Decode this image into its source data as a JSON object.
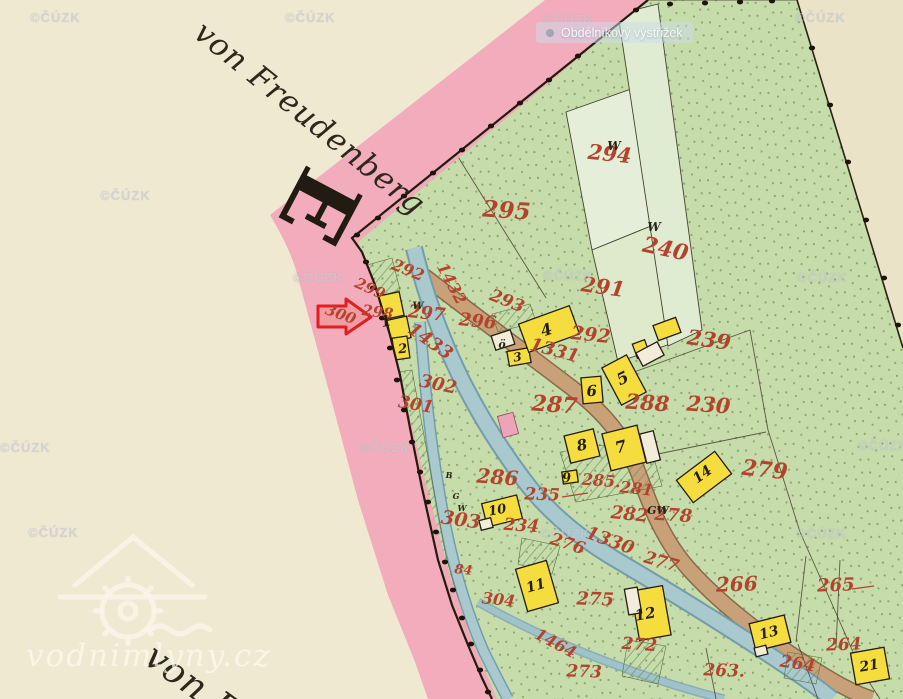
{
  "overlay": {
    "copyright": "©ČÚZK",
    "clip_label": "Obdélníkový výstřižek",
    "brand": "vodnimlyny.cz",
    "watermarks": [
      {
        "x": 30,
        "y": 10
      },
      {
        "x": 285,
        "y": 10
      },
      {
        "x": 543,
        "y": 12
      },
      {
        "x": 795,
        "y": 10
      },
      {
        "x": 100,
        "y": 188
      },
      {
        "x": 293,
        "y": 270
      },
      {
        "x": 543,
        "y": 268
      },
      {
        "x": 797,
        "y": 270
      },
      {
        "x": 0,
        "y": 440
      },
      {
        "x": 360,
        "y": 440
      },
      {
        "x": 858,
        "y": 438
      },
      {
        "x": 28,
        "y": 525
      },
      {
        "x": 540,
        "y": 526
      },
      {
        "x": 796,
        "y": 526
      }
    ]
  },
  "map": {
    "titles": [
      {
        "t": "von Freudenberg",
        "x": 192,
        "y": 36,
        "r": 39,
        "s": 31,
        "kind": "script",
        "n": "region-name-top"
      },
      {
        "t": "E",
        "x": 308,
        "y": 162,
        "r": 118,
        "s": 88,
        "kind": "capital",
        "n": "initial-letter"
      },
      {
        "t": "von F",
        "x": 142,
        "y": 662,
        "r": 36,
        "s": 36,
        "kind": "script",
        "n": "region-name-bottom"
      }
    ],
    "parcel_labels": [
      {
        "t": "295",
        "x": 506,
        "y": 218,
        "r": 4,
        "s": 23
      },
      {
        "t": "294",
        "x": 609,
        "y": 161,
        "r": 6,
        "s": 21
      },
      {
        "t": "291",
        "x": 602,
        "y": 294,
        "r": 8,
        "s": 21
      },
      {
        "t": "240",
        "x": 664,
        "y": 256,
        "r": 12,
        "s": 22
      },
      {
        "t": "239",
        "x": 708,
        "y": 347,
        "r": 8,
        "s": 21
      },
      {
        "t": "292",
        "x": 406,
        "y": 275,
        "r": 22,
        "s": 16
      },
      {
        "t": "299",
        "x": 368,
        "y": 293,
        "r": 24,
        "s": 15
      },
      {
        "t": "300",
        "x": 339,
        "y": 319,
        "r": 20,
        "s": 15
      },
      {
        "t": "298",
        "x": 377,
        "y": 317,
        "r": 8,
        "s": 15
      },
      {
        "t": "297",
        "x": 426,
        "y": 319,
        "r": 6,
        "s": 18
      },
      {
        "t": "296",
        "x": 477,
        "y": 327,
        "r": 6,
        "s": 18
      },
      {
        "t": "293",
        "x": 505,
        "y": 306,
        "r": 22,
        "s": 17
      },
      {
        "t": "292",
        "x": 590,
        "y": 341,
        "r": 6,
        "s": 19
      },
      {
        "t": "1433",
        "x": 427,
        "y": 346,
        "r": 35,
        "s": 18
      },
      {
        "t": "1432",
        "x": 447,
        "y": 286,
        "r": 62,
        "s": 16
      },
      {
        "t": "1331",
        "x": 553,
        "y": 356,
        "r": 15,
        "s": 18
      },
      {
        "t": "302",
        "x": 437,
        "y": 390,
        "r": 12,
        "s": 18
      },
      {
        "t": "301",
        "x": 415,
        "y": 410,
        "r": 10,
        "s": 17
      },
      {
        "t": "287",
        "x": 554,
        "y": 412,
        "r": 4,
        "s": 22
      },
      {
        "t": "288",
        "x": 647,
        "y": 410,
        "r": 4,
        "s": 21
      },
      {
        "t": "230",
        "x": 708,
        "y": 412,
        "r": 4,
        "s": 21
      },
      {
        "t": "303",
        "x": 460,
        "y": 526,
        "r": 8,
        "s": 19
      },
      {
        "t": "84",
        "x": 463,
        "y": 574,
        "r": 6,
        "s": 13
      },
      {
        "t": "304",
        "x": 498,
        "y": 605,
        "r": 6,
        "s": 16
      },
      {
        "t": "286",
        "x": 497,
        "y": 484,
        "r": 4,
        "s": 20
      },
      {
        "t": "235",
        "x": 542,
        "y": 500,
        "r": 2,
        "s": 17
      },
      {
        "t": "234",
        "x": 521,
        "y": 531,
        "r": 4,
        "s": 17
      },
      {
        "t": "285.",
        "x": 601,
        "y": 486,
        "r": 4,
        "s": 16
      },
      {
        "t": "281",
        "x": 636,
        "y": 494,
        "r": 6,
        "s": 16
      },
      {
        "t": "282",
        "x": 629,
        "y": 520,
        "r": 6,
        "s": 18
      },
      {
        "t": "278",
        "x": 673,
        "y": 521,
        "r": 4,
        "s": 18
      },
      {
        "t": "279",
        "x": 764,
        "y": 477,
        "r": 6,
        "s": 22
      },
      {
        "t": "276",
        "x": 566,
        "y": 549,
        "r": 18,
        "s": 17
      },
      {
        "t": "1330",
        "x": 608,
        "y": 546,
        "r": 20,
        "s": 18
      },
      {
        "t": "277",
        "x": 660,
        "y": 567,
        "r": 16,
        "s": 17
      },
      {
        "t": "275",
        "x": 595,
        "y": 605,
        "r": 2,
        "s": 18
      },
      {
        "t": "266",
        "x": 737,
        "y": 591,
        "r": -2,
        "s": 20
      },
      {
        "t": "265",
        "x": 836,
        "y": 591,
        "r": -2,
        "s": 18
      },
      {
        "t": "264",
        "x": 844,
        "y": 650,
        "r": -2,
        "s": 17
      },
      {
        "t": "264",
        "x": 797,
        "y": 669,
        "r": 8,
        "s": 17
      },
      {
        "t": "263.",
        "x": 724,
        "y": 676,
        "r": 2,
        "s": 17
      },
      {
        "t": "272",
        "x": 639,
        "y": 650,
        "r": 4,
        "s": 17
      },
      {
        "t": "273",
        "x": 584,
        "y": 677,
        "r": 2,
        "s": 17
      },
      {
        "t": "1464",
        "x": 553,
        "y": 648,
        "r": 28,
        "s": 16
      }
    ],
    "building_numbers": [
      {
        "t": "1",
        "x": 387,
        "y": 326,
        "r": -12,
        "s": 15
      },
      {
        "t": "2",
        "x": 403,
        "y": 353,
        "r": -5,
        "s": 13
      },
      {
        "t": "3",
        "x": 518,
        "y": 361,
        "r": -8,
        "s": 12
      },
      {
        "t": "4",
        "x": 548,
        "y": 335,
        "r": -18,
        "s": 16
      },
      {
        "t": "5",
        "x": 625,
        "y": 383,
        "r": -26,
        "s": 16
      },
      {
        "t": "6",
        "x": 592,
        "y": 396,
        "r": -3,
        "s": 15
      },
      {
        "t": "7",
        "x": 622,
        "y": 452,
        "r": -14,
        "s": 16
      },
      {
        "t": "8",
        "x": 583,
        "y": 450,
        "r": -12,
        "s": 15
      },
      {
        "t": "9",
        "x": 567,
        "y": 482,
        "r": -5,
        "s": 13
      },
      {
        "t": "10",
        "x": 498,
        "y": 514,
        "r": -10,
        "s": 13
      },
      {
        "t": "11",
        "x": 537,
        "y": 590,
        "r": -16,
        "s": 14
      },
      {
        "t": "12",
        "x": 646,
        "y": 619,
        "r": -10,
        "s": 15
      },
      {
        "t": "13",
        "x": 770,
        "y": 637,
        "r": -14,
        "s": 14
      },
      {
        "t": "14",
        "x": 705,
        "y": 478,
        "r": -36,
        "s": 14
      },
      {
        "t": "21",
        "x": 870,
        "y": 670,
        "r": -10,
        "s": 14
      }
    ],
    "symbols": [
      {
        "t": "W",
        "x": 614,
        "y": 150,
        "r": 0,
        "s": 12
      },
      {
        "t": "W",
        "x": 654,
        "y": 231,
        "r": 0,
        "s": 12
      },
      {
        "t": "W",
        "x": 418,
        "y": 309,
        "r": 0,
        "s": 10
      },
      {
        "t": "GW",
        "x": 658,
        "y": 514,
        "r": 0,
        "s": 11
      },
      {
        "t": "ö",
        "x": 502,
        "y": 348,
        "r": 0,
        "s": 11
      },
      {
        "t": "B",
        "x": 449,
        "y": 478,
        "r": 0,
        "s": 8
      },
      {
        "t": "G",
        "x": 456,
        "y": 499,
        "r": 0,
        "s": 8
      },
      {
        "t": "W",
        "x": 462,
        "y": 511,
        "r": 0,
        "s": 8
      }
    ]
  },
  "colors": {
    "paper": "#f0e9d2",
    "pink_band": "#f2a6ba",
    "green": "#c6dcaa",
    "pale_parcel": "#e4eed8",
    "stream": "#a9c9cf",
    "road": "#c8a178",
    "building_yellow": "#f5dd3f",
    "building_white": "#f2ecda",
    "parcel_number_red": "#b2442e",
    "annotation_arrow_red": "#e01f1f"
  }
}
